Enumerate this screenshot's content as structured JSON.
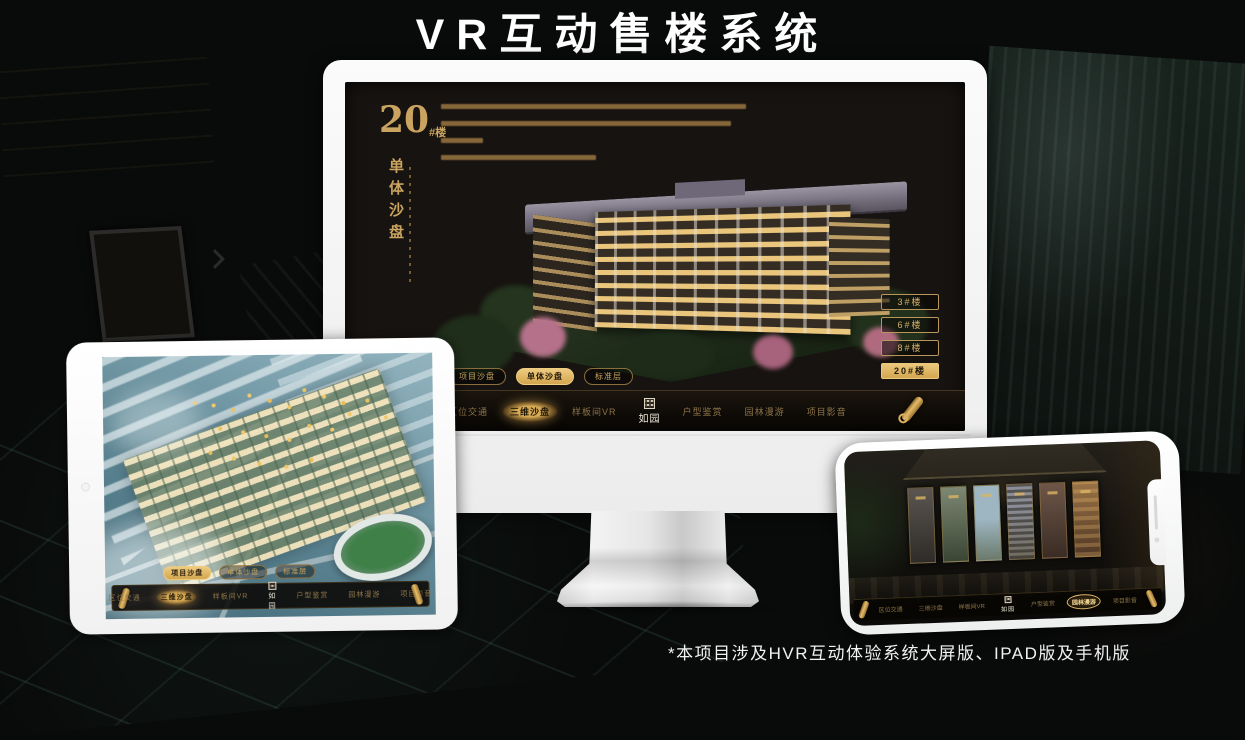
{
  "page": {
    "title": "VR互动售楼系统",
    "footnote": "*本项目涉及HVR互动体验系统大屏版、IPAD版及手机版"
  },
  "colors": {
    "gold": "#c9a35f",
    "gold_bright": "#ecc87c",
    "nav_text": "#8d7448",
    "background": "#090b0a"
  },
  "nav": {
    "logo": "如园",
    "logo_seal_icon": "seal-icon",
    "scroll_icon": "scroll-icon",
    "items": [
      {
        "label": "区位交通"
      },
      {
        "label": "三维沙盘"
      },
      {
        "label": "样板间VR"
      },
      {
        "label": "户型鉴赏"
      },
      {
        "label": "园林漫游"
      },
      {
        "label": "项目影音"
      }
    ]
  },
  "sub_tabs": [
    {
      "label": "项目沙盘"
    },
    {
      "label": "单体沙盘"
    },
    {
      "label": "标准层"
    }
  ],
  "monitor": {
    "heading_number": "20",
    "heading_suffix": "#楼",
    "heading_subtitle": "单体沙盘",
    "active_sub_tab": "单体沙盘",
    "active_nav_item": "三维沙盘",
    "floor_buttons": [
      {
        "label": "3#楼",
        "active": false
      },
      {
        "label": "6#楼",
        "active": false
      },
      {
        "label": "8#楼",
        "active": false
      },
      {
        "label": "20#楼",
        "active": true
      }
    ]
  },
  "tablet": {
    "active_sub_tab": "项目沙盘",
    "active_nav_item": "三维沙盘"
  },
  "phone": {
    "active_nav_item": "园林漫游",
    "gallery_panel_count": 6
  }
}
